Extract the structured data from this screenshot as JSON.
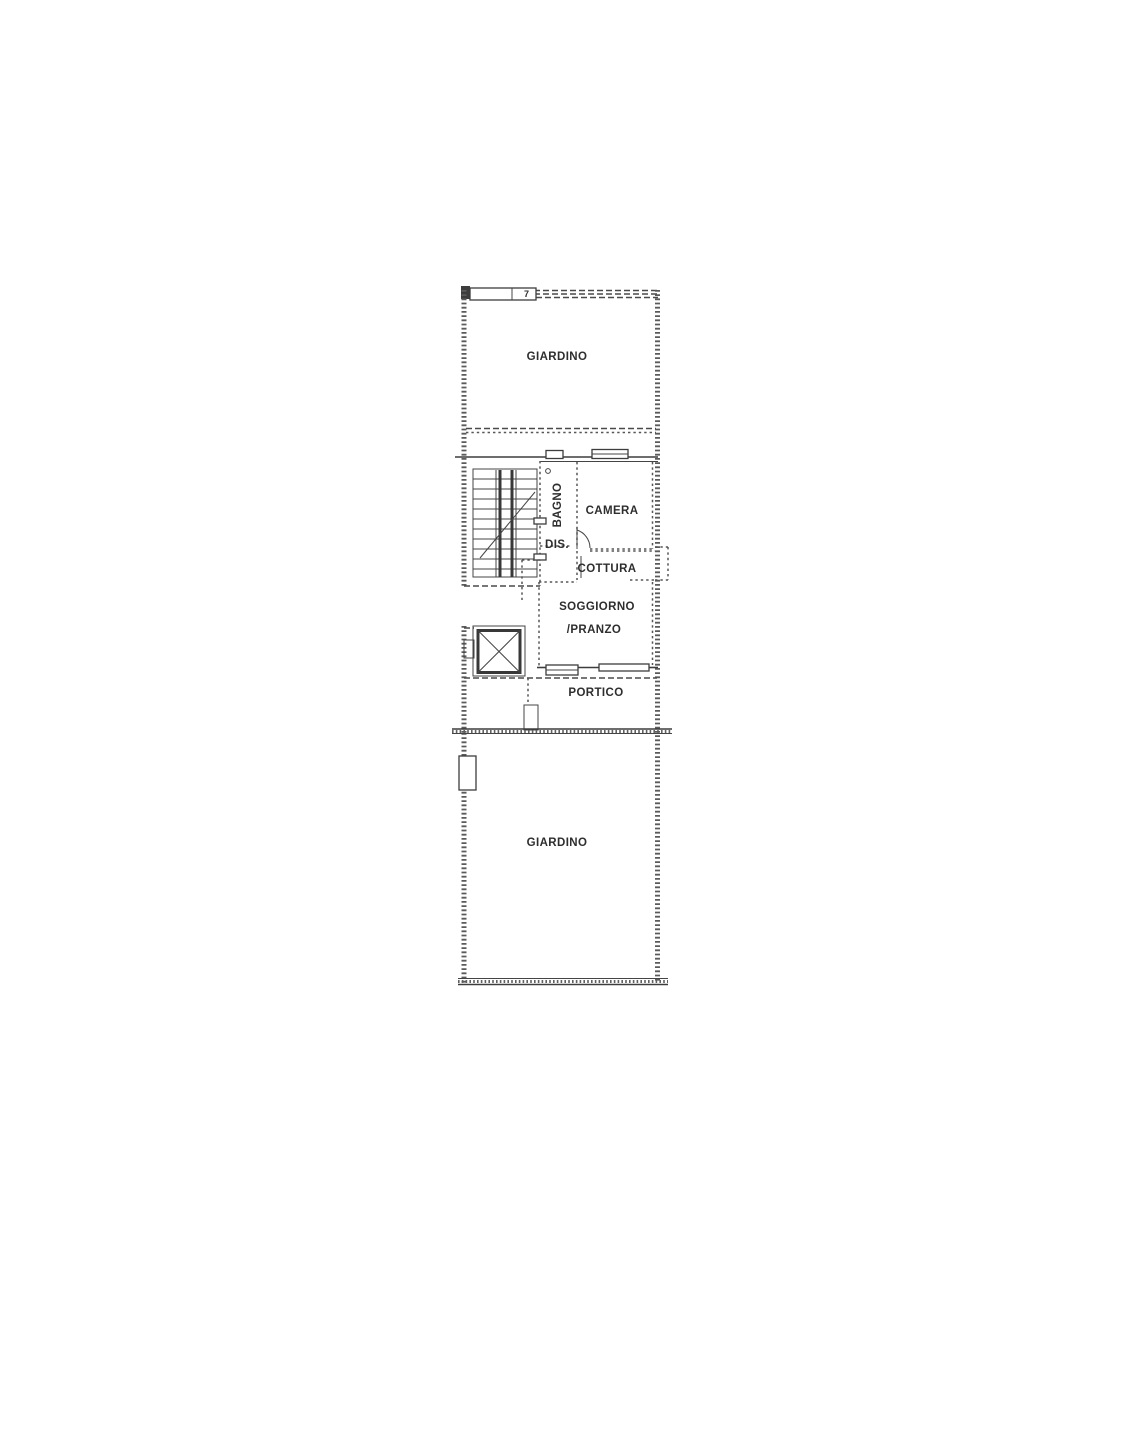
{
  "plan": {
    "title": "floor-plan",
    "background_color": "#ffffff",
    "ink_color": "#3d3d3d",
    "rooms": {
      "garden_top": {
        "label": "GIARDINO"
      },
      "bathroom": {
        "label": "BAGNO"
      },
      "bedroom": {
        "label": "CAMERA"
      },
      "hallway": {
        "label": "DIS."
      },
      "kitchen": {
        "label": "COTTURA"
      },
      "living_line1": {
        "label": "SOGGIORNO"
      },
      "living_line2": {
        "label": "/PRANZO"
      },
      "porch": {
        "label": "PORTICO"
      },
      "garden_bottom": {
        "label": "GIARDINO"
      }
    },
    "annotations": {
      "gate_number": "7"
    }
  }
}
